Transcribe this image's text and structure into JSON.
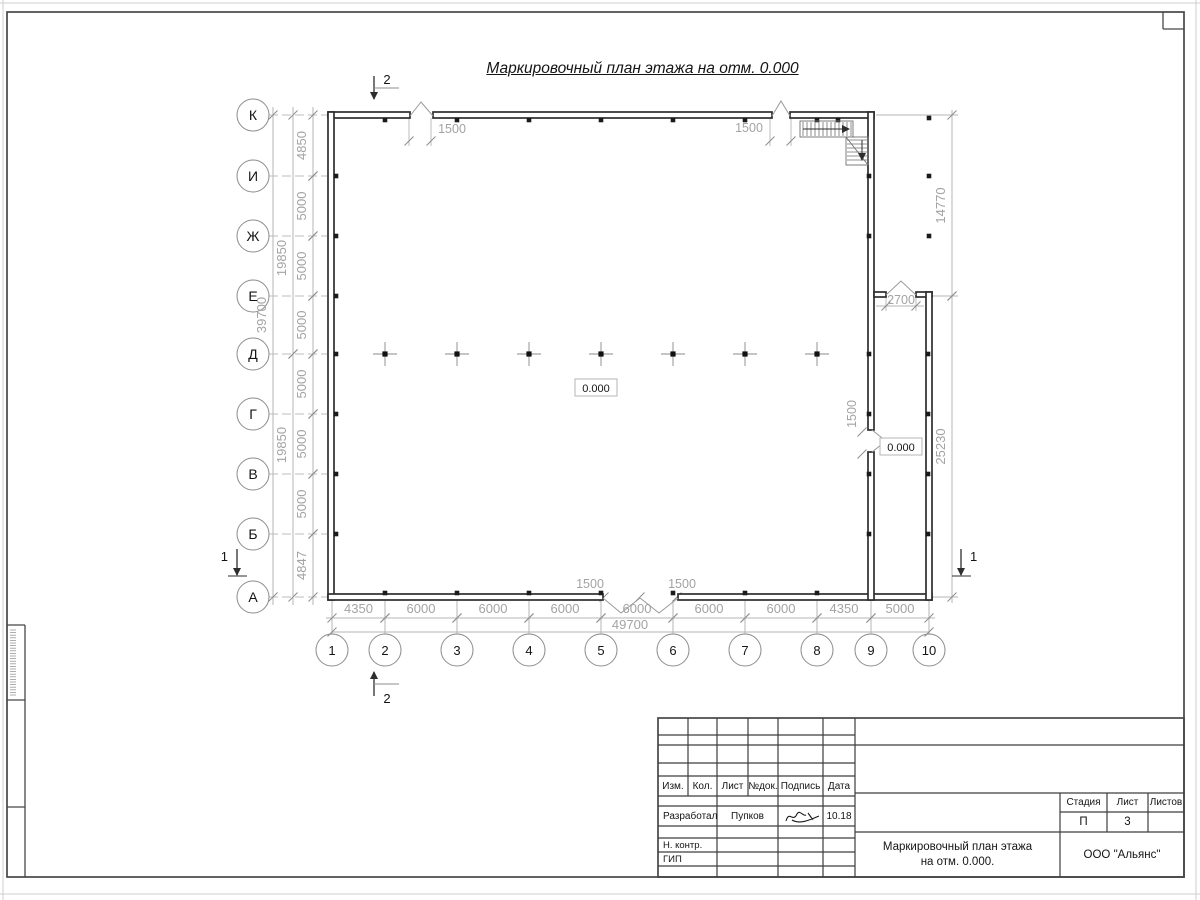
{
  "plan_title": "Маркировочный план этажа на отм. 0.000",
  "plan": {
    "row_axes": [
      [
        "К",
        115
      ],
      [
        "И",
        176
      ],
      [
        "Ж",
        236
      ],
      [
        "Е",
        296
      ],
      [
        "Д",
        354
      ],
      [
        "Г",
        414
      ],
      [
        "В",
        474
      ],
      [
        "Б",
        534
      ],
      [
        "А",
        597
      ]
    ],
    "col_axes": [
      [
        "1",
        332
      ],
      [
        "2",
        385
      ],
      [
        "3",
        457
      ],
      [
        "4",
        529
      ],
      [
        "5",
        601
      ],
      [
        "6",
        673
      ],
      [
        "7",
        745
      ],
      [
        "8",
        817
      ],
      [
        "9",
        871
      ],
      [
        "10",
        929
      ]
    ],
    "left_dims": {
      "seg_x": 313,
      "group_x": 293,
      "total_x": 273,
      "segments": [
        [
          "К",
          "И",
          "4850"
        ],
        [
          "И",
          "Ж",
          "5000"
        ],
        [
          "Ж",
          "Е",
          "5000"
        ],
        [
          "Е",
          "Д",
          "5000"
        ],
        [
          "Д",
          "Г",
          "5000"
        ],
        [
          "Г",
          "В",
          "5000"
        ],
        [
          "В",
          "Б",
          "5000"
        ],
        [
          "Б",
          "А",
          "4847"
        ]
      ],
      "groups": [
        [
          "К",
          "Д",
          "19850",
          258
        ],
        [
          "Д",
          "А",
          "19850",
          445
        ]
      ],
      "total": [
        "К",
        "А",
        "39700",
        315
      ]
    },
    "bottom_dims": {
      "seg_y": 618,
      "total_y": 632,
      "segments": [
        [
          "1",
          "2",
          "4350"
        ],
        [
          "2",
          "3",
          "6000"
        ],
        [
          "3",
          "4",
          "6000"
        ],
        [
          "4",
          "5",
          "6000"
        ],
        [
          "5",
          "6",
          "6000"
        ],
        [
          "6",
          "7",
          "6000"
        ],
        [
          "7",
          "8",
          "6000"
        ],
        [
          "8",
          "9",
          "4350"
        ],
        [
          "9",
          "10",
          "5000"
        ]
      ],
      "total": [
        "1",
        "10",
        "49700",
        630,
        629
      ]
    },
    "right_dims": {
      "x": 952,
      "segments": [
        [
          115,
          296,
          "14770"
        ],
        [
          296,
          597,
          "25230"
        ]
      ],
      "ext": [
        [
          876,
          115,
          958,
          115
        ],
        [
          932,
          296,
          958,
          296
        ],
        [
          932,
          597,
          958,
          597
        ]
      ]
    },
    "walls": [
      [
        328,
        112,
        82,
        6
      ],
      [
        433,
        112,
        339,
        6
      ],
      [
        790,
        112,
        84,
        6
      ],
      [
        328,
        112,
        6,
        488
      ],
      [
        328,
        594,
        275,
        6
      ],
      [
        678,
        594,
        254,
        6
      ],
      [
        868,
        112,
        6,
        318
      ],
      [
        868,
        452,
        6,
        148
      ],
      [
        874,
        292,
        12,
        5
      ],
      [
        916,
        292,
        16,
        5
      ],
      [
        926,
        292,
        6,
        308
      ]
    ],
    "peaks": [
      [
        [
          410,
          116
        ],
        [
          421,
          102
        ],
        [
          433,
          116
        ]
      ],
      [
        [
          772,
          116
        ],
        [
          781,
          101
        ],
        [
          790,
          116
        ]
      ],
      [
        [
          886,
          295
        ],
        [
          901,
          281
        ],
        [
          916,
          295
        ]
      ],
      [
        [
          603,
          598
        ],
        [
          621,
          613
        ],
        [
          640,
          598
        ]
      ],
      [
        [
          640,
          598
        ],
        [
          659,
          613
        ],
        [
          678,
          598
        ]
      ],
      [
        [
          872,
          430
        ],
        [
          886,
          441
        ],
        [
          872,
          452
        ]
      ]
    ],
    "opening_dims": [
      [
        "1500",
        452,
        133,
        0
      ],
      [
        "1500",
        749,
        132,
        0
      ],
      [
        "2700",
        901,
        304,
        0
      ],
      [
        "1500",
        856,
        414,
        1
      ],
      [
        "1500",
        590,
        588,
        0
      ],
      [
        "1500",
        682,
        588,
        0
      ]
    ],
    "opening_ticks": [
      [
        409,
        141
      ],
      [
        431,
        141
      ],
      [
        770,
        141
      ],
      [
        791,
        141
      ],
      [
        886,
        306
      ],
      [
        916,
        306
      ],
      [
        604,
        597
      ],
      [
        640,
        597
      ],
      [
        677,
        597
      ],
      [
        862,
        432
      ],
      [
        862,
        454
      ]
    ],
    "opening_ext": [
      [
        409,
        118,
        409,
        146
      ],
      [
        431,
        118,
        431,
        146
      ],
      [
        770,
        118,
        770,
        146
      ],
      [
        791,
        118,
        791,
        146
      ],
      [
        886,
        297,
        886,
        311
      ],
      [
        916,
        297,
        916,
        311
      ],
      [
        876,
        306,
        924,
        306
      ]
    ],
    "elevations": [
      [
        "0.000",
        596,
        388
      ],
      [
        "0.000",
        901,
        447
      ]
    ],
    "interior_columns": {
      "y": 354,
      "xs": [
        385,
        457,
        529,
        601,
        673,
        745,
        817
      ]
    },
    "wall_squares": [
      [
        385,
        120
      ],
      [
        457,
        120
      ],
      [
        529,
        120
      ],
      [
        601,
        120
      ],
      [
        673,
        120
      ],
      [
        745,
        120
      ],
      [
        817,
        120
      ],
      [
        385,
        593
      ],
      [
        457,
        593
      ],
      [
        529,
        593
      ],
      [
        601,
        593
      ],
      [
        673,
        593
      ],
      [
        745,
        593
      ],
      [
        817,
        593
      ],
      [
        336,
        176
      ],
      [
        336,
        236
      ],
      [
        336,
        296
      ],
      [
        336,
        354
      ],
      [
        336,
        414
      ],
      [
        336,
        474
      ],
      [
        336,
        534
      ],
      [
        869,
        176
      ],
      [
        869,
        236
      ],
      [
        869,
        354
      ],
      [
        869,
        414
      ],
      [
        869,
        474
      ],
      [
        869,
        534
      ],
      [
        928,
        354
      ],
      [
        928,
        414
      ],
      [
        928,
        474
      ],
      [
        928,
        534
      ]
    ],
    "free_squares": [
      [
        929,
        118
      ],
      [
        929,
        176
      ],
      [
        929,
        236
      ],
      [
        838,
        120
      ]
    ],
    "sections": [
      {
        "label": "2",
        "x": 374,
        "y1": 76,
        "y2": 99,
        "arrow": "down",
        "hy": 88,
        "hx2": 399,
        "lx": 387,
        "ly": 84,
        "anchor": "middle"
      },
      {
        "label": "2",
        "x": 374,
        "y1": 696,
        "y2": 672,
        "arrow": "up",
        "hy": 684,
        "hx2": 399,
        "lx": 387,
        "ly": 703,
        "anchor": "middle"
      },
      {
        "label": "1",
        "x": 237,
        "y1": 549,
        "y2": 575,
        "arrow": "down",
        "base": 576,
        "lx": 228,
        "ly": 561,
        "anchor": "end"
      },
      {
        "label": "1",
        "x": 961,
        "y1": 549,
        "y2": 575,
        "arrow": "down",
        "base": 576,
        "lx": 970,
        "ly": 561,
        "anchor": "start"
      }
    ],
    "stairs": {
      "h_rect": [
        800,
        121,
        53,
        16
      ],
      "v_rect": [
        846,
        137,
        22,
        28
      ],
      "arrow1": [
        803,
        129,
        849,
        129
      ],
      "arrow2": [
        862,
        140,
        862,
        160
      ],
      "diag": [
        846,
        137,
        868,
        165
      ]
    }
  },
  "title_block": {
    "headers": [
      "Изм.",
      "Кол.",
      "Лист",
      "№док.",
      "Подпись",
      "Дата"
    ],
    "rows": [
      {
        "role": "Разработал",
        "name": "Пупков",
        "date": "10.18"
      },
      {
        "role": "Н. контр.",
        "name": "",
        "date": ""
      },
      {
        "role": "ГИП",
        "name": "",
        "date": ""
      }
    ],
    "stage_label": "Стадия",
    "sheet_label": "Лист",
    "sheets_label": "Листов",
    "stage": "П",
    "sheet_no": "3",
    "doc_title_line1": "Маркировочный план этажа",
    "doc_title_line2": "на отм. 0.000.",
    "org": "ООО \"Альянс\""
  }
}
